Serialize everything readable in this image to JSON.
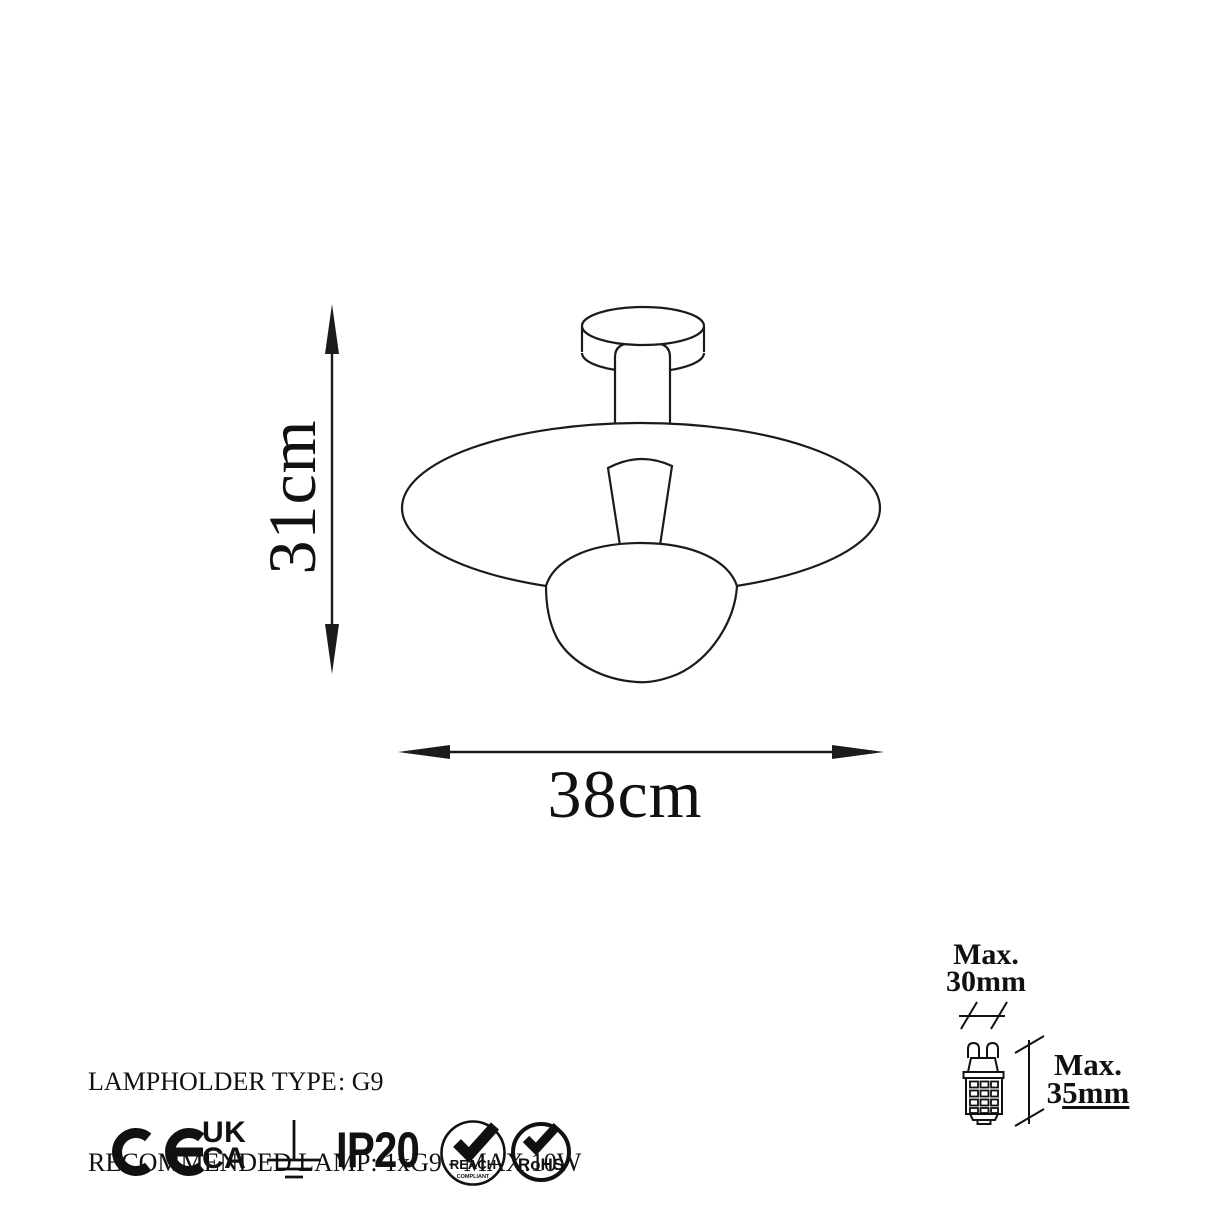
{
  "page": {
    "background": "#ffffff",
    "line_color": "#1b1b1b"
  },
  "dimensions": {
    "height": "31cm",
    "width": "38cm"
  },
  "specs": {
    "lampholder_label": "LAMPHOLDER TYPE",
    "lampholder_value": ": G9",
    "recommended_lamp": "RECOMMENDED LAMP: 1xG9 - MAX.10W"
  },
  "bulb_spec": {
    "max_width_line1": "Max.",
    "max_width_line2": "30mm",
    "max_height_line1": "Max.",
    "max_height_value_prefix": "3",
    "max_height_value_underlined": "5mm"
  },
  "certifications": {
    "ce_mark": "CE",
    "ukca_top": "UK",
    "ukca_bottom": "CA",
    "ip_rating": "IP20",
    "reach": "REACH",
    "reach_sub": "COMPLIANT",
    "rohs": "RoHS"
  }
}
